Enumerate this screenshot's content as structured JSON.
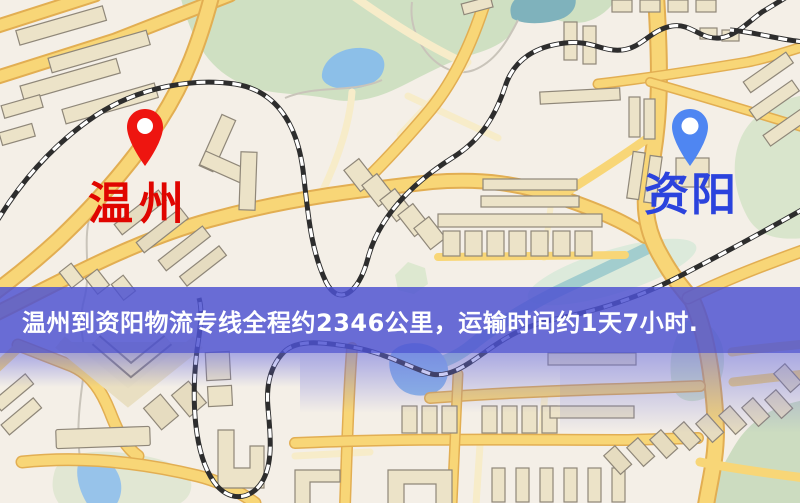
{
  "banner": {
    "text": "温州到资阳物流专线全程约2346公里，运输时间约1天7小时.",
    "background": "#4d52d2",
    "text_color": "#ffffff"
  },
  "origin": {
    "label": "温州",
    "label_color": "#e00500",
    "pin_color": "#ee1510"
  },
  "destination": {
    "label": "资阳",
    "label_color": "#2b43dd",
    "pin_color": "#4f86f2"
  },
  "route_summary": {
    "distance_text": "约2346公里",
    "duration_text": "约1天7小时"
  },
  "map_colors": {
    "background": "#f4efe7",
    "road_major": "#f8d677",
    "road_minor": "#f7ecc9",
    "park": "#cfe0c2",
    "water": "#8fc0e8",
    "building": "#ece3c8",
    "railway": "#2d2d2d"
  }
}
